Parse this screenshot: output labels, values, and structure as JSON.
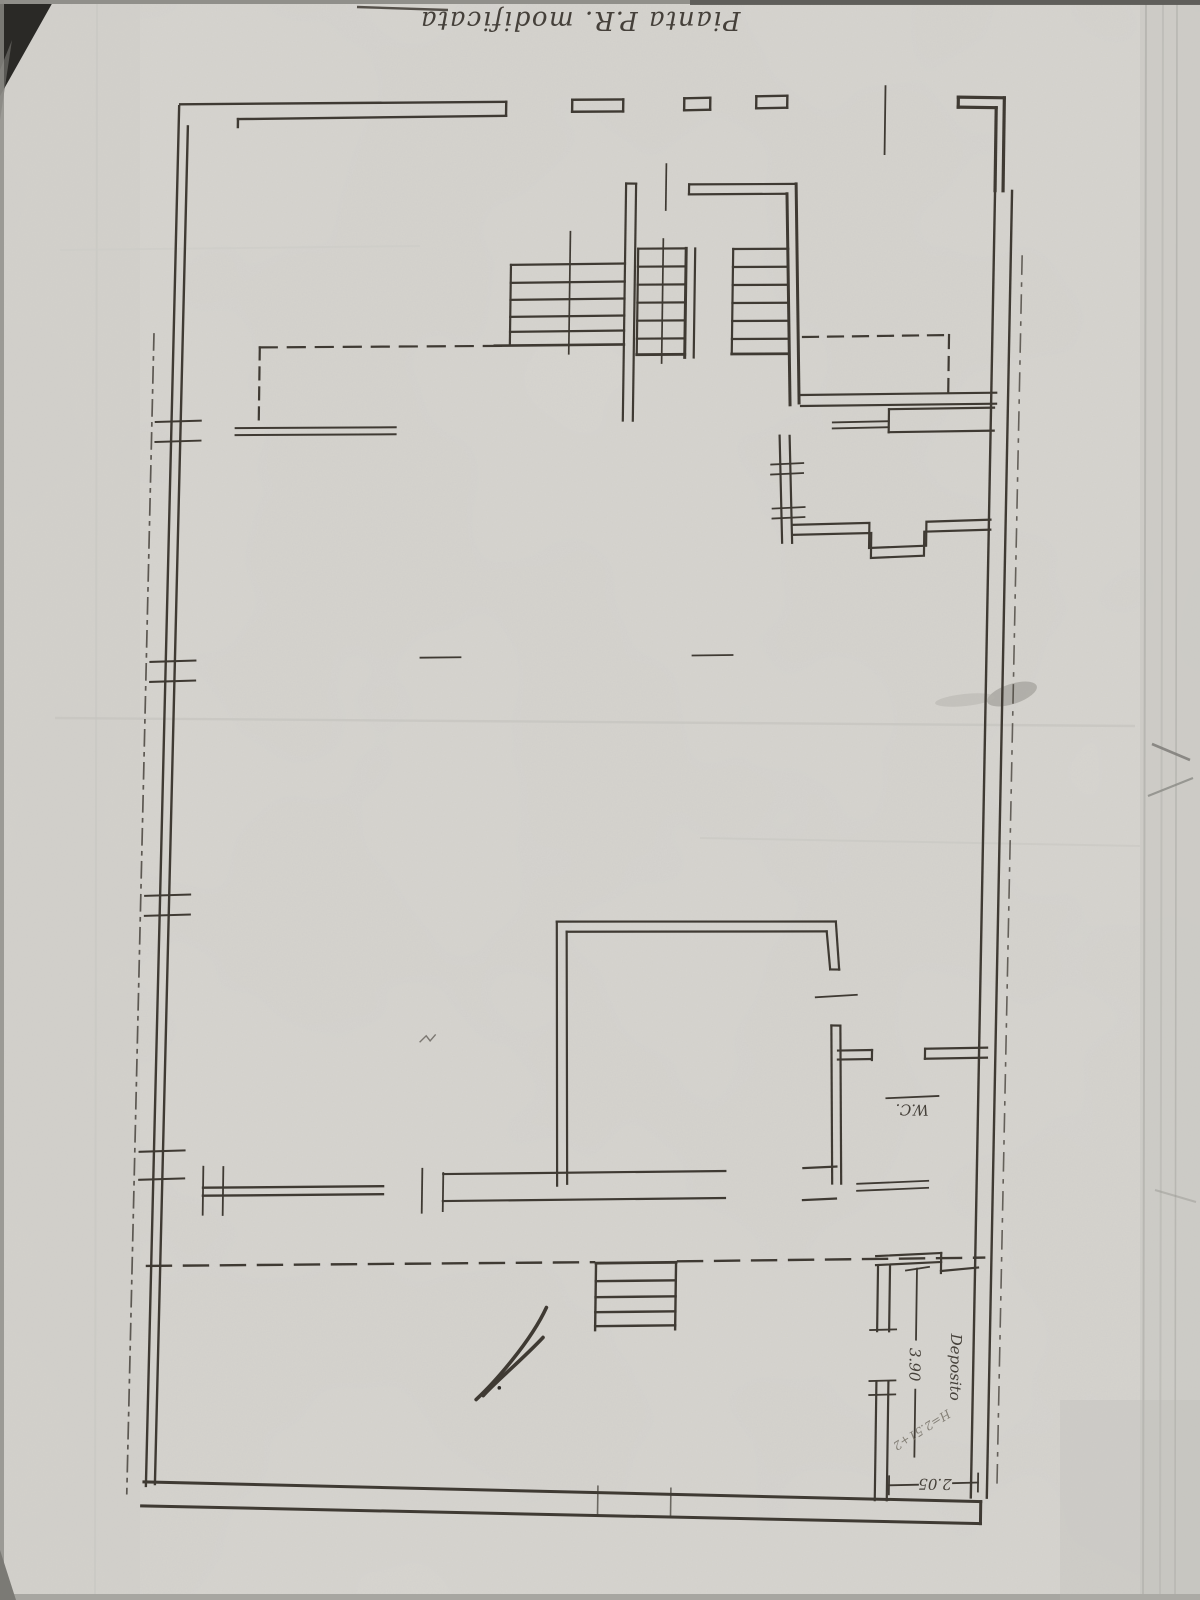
{
  "drawing": {
    "title": "Pianta P.R. modificata",
    "rooms": [
      {
        "name": "Deposito"
      },
      {
        "name": "W.C."
      }
    ],
    "dimensions": {
      "deposito_depth": "3.90",
      "deposito_width": "2.05",
      "height_note": "H=2.51+2"
    },
    "colors": {
      "paper": "#d7d5d0",
      "ink": "#3f3a33",
      "pencil": "#8e8a82",
      "shadow": "#23221f"
    }
  }
}
